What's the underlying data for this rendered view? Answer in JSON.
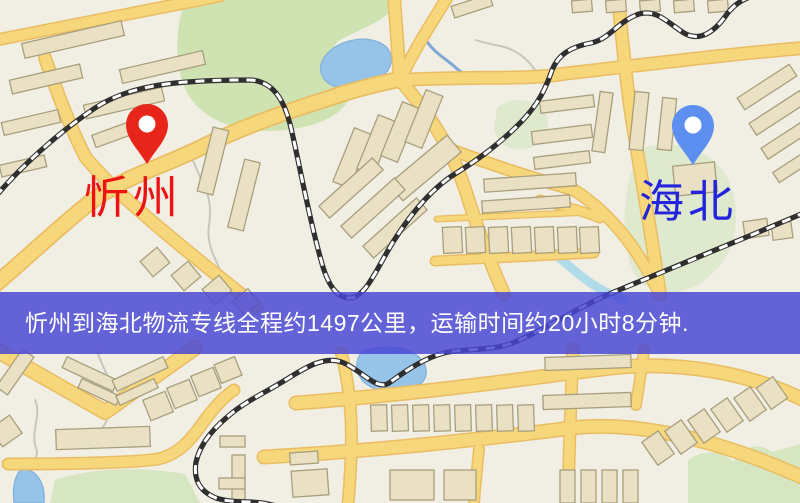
{
  "map": {
    "origin": {
      "label": "忻州",
      "label_color": "#ee1212",
      "pin_color": "#e8251b"
    },
    "destination": {
      "label": "海北",
      "label_color": "#2424dc",
      "pin_color": "#5d8ff0"
    },
    "banner": {
      "text": "忻州到海北物流专线全程约1497公里，运输时间约20小时8分钟.",
      "background": "rgba(73,70,212,0.84)",
      "text_color": "#ffffff"
    },
    "route_summary": {
      "from": "忻州",
      "to": "海北",
      "service": "物流专线",
      "distance_text": "约1497公里",
      "duration_text": "约20小时8分钟"
    }
  },
  "palette": {
    "map_background": "#f1eee4",
    "road_fill": "#f6d77b",
    "road_casing": "#eabd62",
    "building_fill": "#eae1c4",
    "building_stroke": "#a89f7d",
    "park_green": "#cfe2b2",
    "hill_green": "#dfe9cd",
    "water_blue": "#96c3e8",
    "railway_dark": "#2f2f2f",
    "banner_purple": "#5a57d8"
  }
}
